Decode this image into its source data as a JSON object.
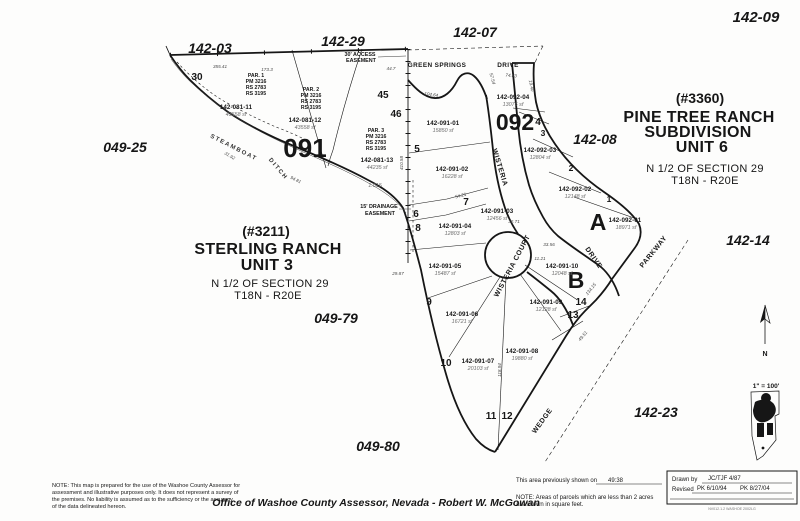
{
  "sheet_refs": {
    "s142_03": "142-03",
    "s142_29": "142-29",
    "s142_07": "142-07",
    "s142_09": "142-09",
    "s049_25": "049-25",
    "s142_08": "142-08",
    "s142_14": "142-14",
    "s142_23": "142-23",
    "s049_79": "049-79",
    "s049_80": "049-80"
  },
  "blocks": {
    "b091": "091",
    "b092": "092",
    "blockA": "A",
    "blockB": "B"
  },
  "titles": {
    "sterling": {
      "permit": "(#3211)",
      "line1": "STERLING RANCH",
      "line2": "UNIT 3",
      "section": "N 1/2 OF SECTION 29",
      "township": "T18N - R20E"
    },
    "pine_tree": {
      "permit": "(#3360)",
      "line1": "PINE TREE RANCH",
      "line2": "SUBDIVISION",
      "line3": "UNIT 6",
      "section": "N 1/2 OF SECTION 29",
      "township": "T18N - R20E"
    }
  },
  "streets": {
    "green_springs": "GREEN SPRINGS",
    "drive_top": "DRIVE",
    "wisteria": "WISTERIA",
    "wisteria_court": "WISTERIA COURT",
    "drive_right": "DRIVE",
    "parkway": "PARKWAY",
    "wedge": "WEDGE",
    "steamboat": "STEAMBOAT",
    "ditch": "DITCH"
  },
  "easements": {
    "access1": "30' ACCESS",
    "access2": "EASEMENT",
    "drainage1": "15' DRAINAGE",
    "drainage2": "EASEMENT"
  },
  "par_notes": [
    {
      "l1": "PAR. 1",
      "l2": "PM 3216",
      "l3": "RS 2783",
      "l4": "RS 3195"
    },
    {
      "l1": "PAR. 2",
      "l2": "PM 3216",
      "l3": "RS 2783",
      "l4": "RS 3195"
    },
    {
      "l1": "PAR. 3",
      "l2": "PM 3216",
      "l3": "RS 2783",
      "l4": "RS 3195"
    }
  ],
  "parcels": [
    {
      "apn": "142-081-11",
      "area": "43558  sf"
    },
    {
      "apn": "142-081-12",
      "area": "43558  sf"
    },
    {
      "apn": "142-081-13",
      "area": "44235  sf",
      "acres": "1.015"
    },
    {
      "apn": "142-091-01",
      "area": "15850  sf"
    },
    {
      "apn": "142-091-02",
      "area": "16228  sf"
    },
    {
      "apn": "142-091-03",
      "area": "12456  sf"
    },
    {
      "apn": "142-091-04",
      "area": "12803  sf"
    },
    {
      "apn": "142-091-05",
      "area": "15487  sf"
    },
    {
      "apn": "142-091-06",
      "area": "16721  sf"
    },
    {
      "apn": "142-091-07",
      "area": "20103  sf"
    },
    {
      "apn": "142-091-08",
      "area": "19880  sf"
    },
    {
      "apn": "142-091-09",
      "area": "12128  sf"
    },
    {
      "apn": "142-091-10",
      "area": "12048  sf"
    },
    {
      "apn": "142-092-01",
      "area": "18971  sf"
    },
    {
      "apn": "142-092-02",
      "area": "12148  sf"
    },
    {
      "apn": "142-092-03",
      "area": "12804  sf"
    },
    {
      "apn": "142-092-04",
      "area": "13076  sf"
    }
  ],
  "lots": [
    "30",
    "45",
    "46",
    "5",
    "6",
    "7",
    "8",
    "9",
    "10",
    "11",
    "12",
    "13",
    "14",
    "1",
    "2",
    "3",
    "4"
  ],
  "dims": [
    "355.41",
    "173.3",
    "44.7",
    "57.54",
    "74.83",
    "104.64",
    "410.58",
    "118.94",
    "32.71",
    "33.56",
    "11.21",
    "29.87",
    "31.92",
    "94.81",
    "54.21",
    "134.15",
    "49.51",
    "19.40"
  ],
  "compass": {
    "label": "N"
  },
  "scale_note": "1\" = 100'",
  "footer": {
    "note_left_lines": [
      "NOTE: This map is prepared for the use of the Washoe County Assessor for",
      "assessment and illustrative purposes only.  It does not represent a survey of",
      "the premises.   No liability is assumed as to the sufficiency or the accuracy",
      "of the data delineated hereon."
    ],
    "office": "Office of Washoe County Assessor, Nevada - Robert W. McGowan",
    "prev_label": "This area previously shown on",
    "prev_value": "49:38",
    "note_right_1": "NOTE:  Areas of parcels which are less than 2 acres",
    "note_right_2": "are shown in square feet.",
    "drawn_label": "Drawn by",
    "drawn_value": "JC/TJF  4/87",
    "revised_label": "Revised",
    "revised_value1": "PK  6/10/94",
    "revised_value2": "PK  8/27/04",
    "fine_print": "NV012.1.2  WASHOE 2002LG"
  }
}
